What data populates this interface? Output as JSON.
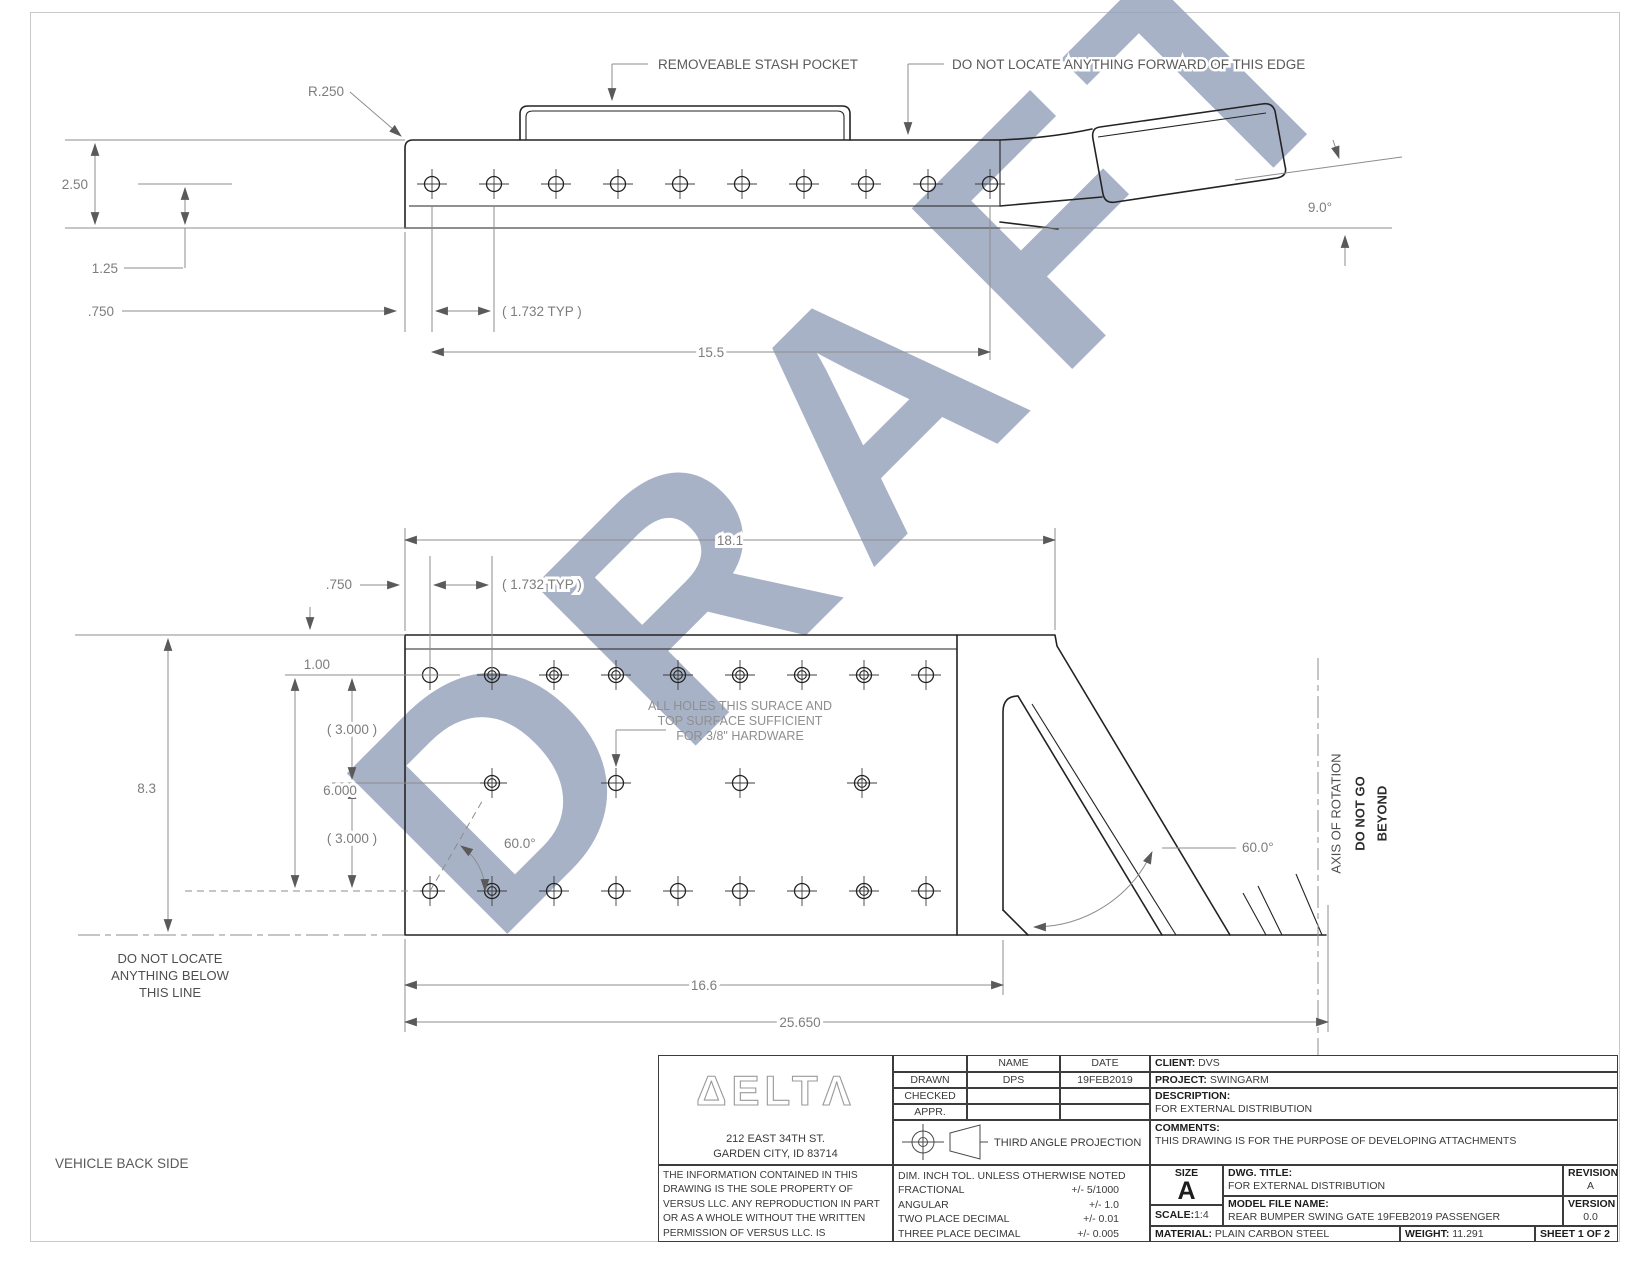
{
  "watermark": "DRAFT",
  "page": {
    "footer_note": "VEHICLE BACK SIDE"
  },
  "top_view": {
    "labels": {
      "stash_pocket": "REMOVEABLE STASH POCKET",
      "forward_edge": "DO NOT LOCATE ANYTHING FORWARD OF THIS EDGE"
    },
    "dims": {
      "radius": "R.250",
      "height": "2.50",
      "hole_offset": "1.25",
      "edge_margin": ".750",
      "hole_pitch": "( 1.732 TYP )",
      "hole_span": "15.5",
      "arm_angle": "9.0°"
    }
  },
  "bottom_view": {
    "labels": {
      "holes_note": "ALL HOLES THIS SURACE AND\nTOP SURFACE SUFFICIENT\nFOR 3/8\" HARDWARE",
      "below_line": "DO NOT LOCATE\nANYTHING BELOW\nTHIS LINE",
      "axis": "AXIS OF ROTATION",
      "axis_bold1": "DO NOT GO",
      "axis_bold2": "BEYOND"
    },
    "dims": {
      "width": "18.1",
      "edge_margin": ".750",
      "hole_pitch": "( 1.732 TYP )",
      "top_offset": "1.00",
      "row_gap_upper": "( 3.000 )",
      "row_span": "6.000",
      "row_gap_lower": "( 3.000 )",
      "height": "8.3",
      "hole_angle": "60.0°",
      "arm_angle": "60.0°",
      "base_length": "16.6",
      "total_length": "25.650"
    }
  },
  "title_block": {
    "logo_text": "ΔELTΛ",
    "address": "212 EAST 34TH ST.\nGARDEN CITY, ID 83714",
    "legal": "THE INFORMATION CONTAINED IN THIS\nDRAWING IS THE SOLE PROPERTY OF\nVERSUS LLC. ANY REPRODUCTION IN PART\nOR AS A WHOLE WITHOUT THE WRITTEN\nPERMISSION OF VERSUS LLC. IS PROHIBITED",
    "approval": {
      "headers": {
        "name": "NAME",
        "date": "DATE"
      },
      "rows": [
        {
          "label": "DRAWN",
          "name": "DPS",
          "date": "19FEB2019"
        },
        {
          "label": "CHECKED",
          "name": "",
          "date": ""
        },
        {
          "label": "APPR.",
          "name": "",
          "date": ""
        }
      ]
    },
    "projection": "THIRD ANGLE PROJECTION",
    "tolerances": {
      "title": "DIM. INCH TOL. UNLESS OTHERWISE NOTED",
      "rows": [
        {
          "label": "FRACTIONAL",
          "value": "+/- 5/1000"
        },
        {
          "label": "ANGULAR",
          "value": "+/- 1.0"
        },
        {
          "label": "TWO PLACE DECIMAL",
          "value": "+/- 0.01"
        },
        {
          "label": "THREE PLACE DECIMAL",
          "value": "+/- 0.005"
        }
      ]
    },
    "client_label": "CLIENT:",
    "client": "DVS",
    "project_label": "PROJECT:",
    "project": "SWINGARM",
    "description_label": "DESCRIPTION:",
    "description": "FOR EXTERNAL DISTRIBUTION",
    "comments_label": "COMMENTS:",
    "comments": "THIS DRAWING IS FOR THE PURPOSE OF DEVELOPING ATTACHMENTS",
    "size_label": "SIZE",
    "size": "A",
    "scale_label": "SCALE:",
    "scale": "1:4",
    "dwg_title_label": "DWG.  TITLE:",
    "dwg_title": "FOR EXTERNAL DISTRIBUTION",
    "model_label": "MODEL FILE NAME:",
    "model": "REAR BUMPER SWING GATE 19FEB2019 PASSENGER",
    "revision_label": "REVISION",
    "revision": "A",
    "version_label": "VERSION",
    "version": "0.0",
    "material_label": "MATERIAL:",
    "material": "PLAIN CARBON STEEL",
    "weight_label": "WEIGHT:",
    "weight": "11.291",
    "sheet": "SHEET 1 OF 2"
  }
}
